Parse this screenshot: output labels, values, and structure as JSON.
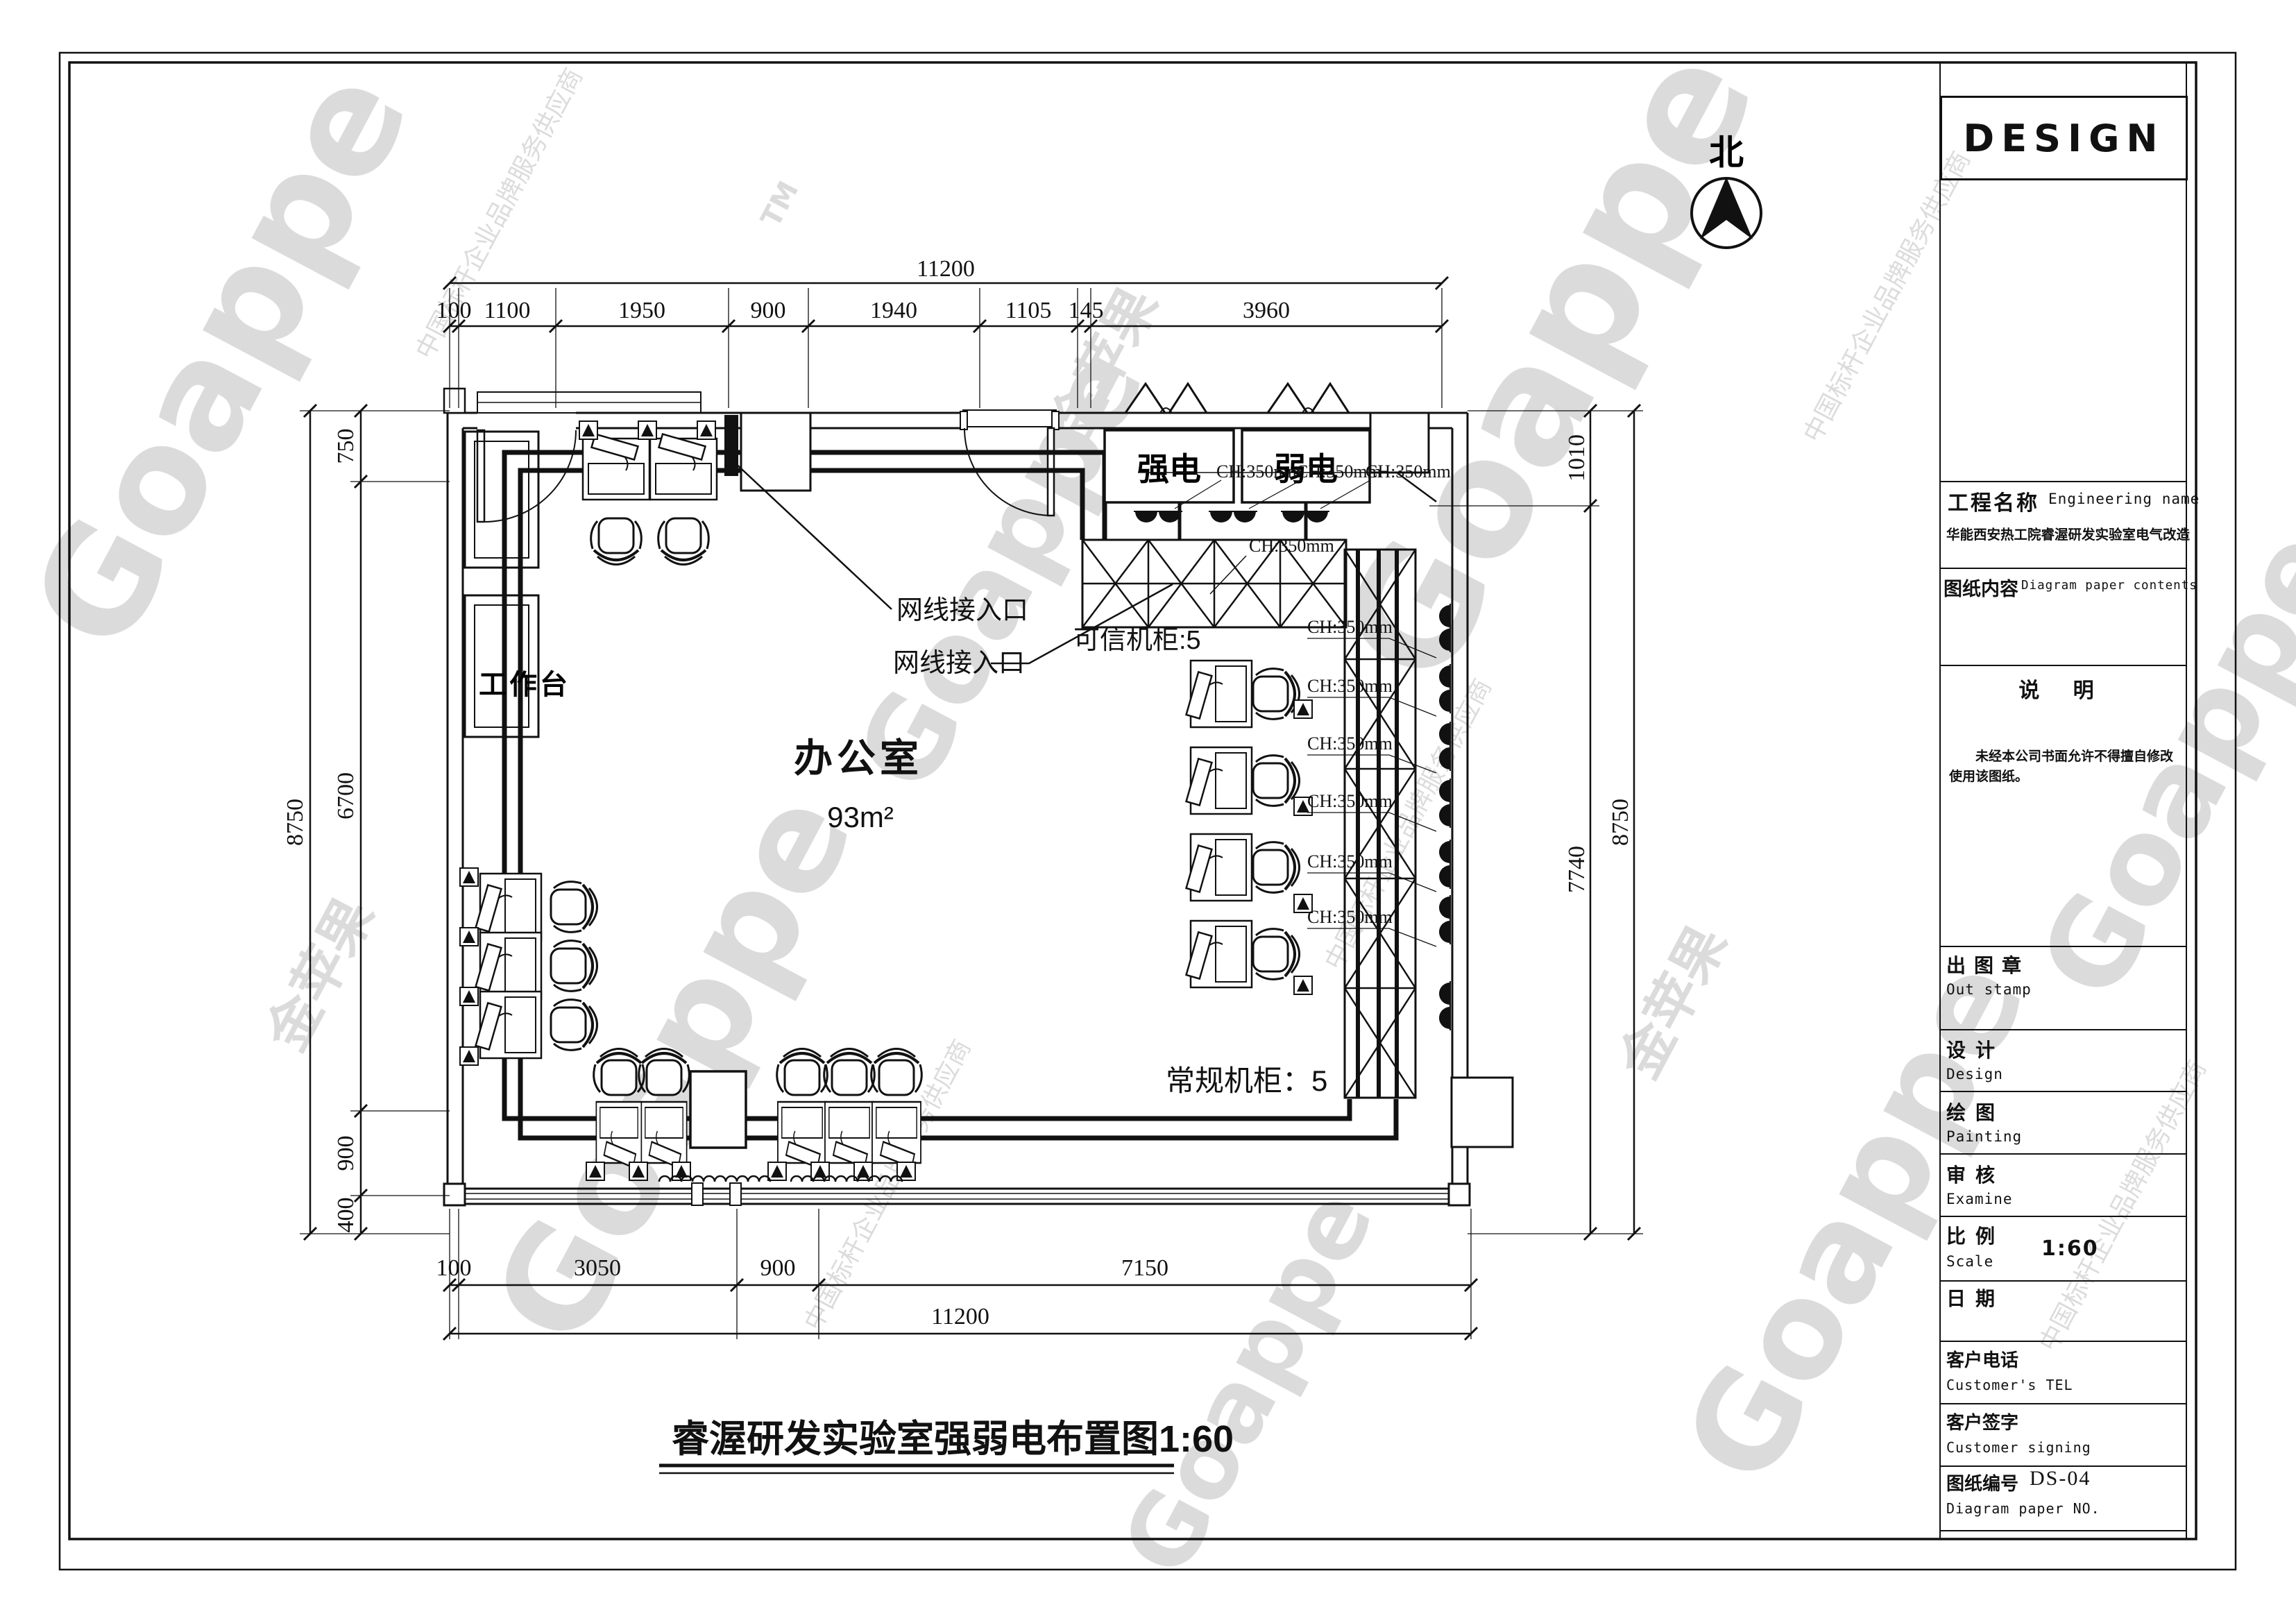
{
  "watermark": {
    "brand": "Goappe",
    "name_cn": "金苹果",
    "tagline": "中国标杆企业品牌服务供应商",
    "tm": "TM"
  },
  "north": {
    "label": "北"
  },
  "plan": {
    "room_name": "办公室",
    "room_area": "93m²",
    "strong_power": "强电",
    "weak_power": "弱电",
    "workbench": "工作台",
    "net_port": "网线接入口",
    "trusted_cabinet": "可信机柜:5",
    "regular_cabinet": "常规机柜：5",
    "cable_height": "CH:350mm",
    "title": "睿渥研发实验室强弱电布置图1:60"
  },
  "dims": {
    "top_total": "11200",
    "top_segments": [
      "100",
      "1100",
      "1950",
      "900",
      "1940",
      "1105",
      "145",
      "3960"
    ],
    "left_total": "8750",
    "left_segments": [
      "750",
      "6700",
      "900",
      "400"
    ],
    "right_segments": [
      "1010",
      "7740"
    ],
    "right_total": "8750",
    "bottom_segments": [
      "100",
      "3050",
      "900",
      "7150"
    ],
    "bottom_total": "11200"
  },
  "titleblock": {
    "brand": "DESIGN",
    "project_label": "工程名称",
    "project_label_en": "Engineering name",
    "project_name": "华能西安热工院睿渥研发实验室电气改造",
    "content_label": "图纸内容",
    "content_label_en": "Diagram paper contents",
    "notes_title": "说 明",
    "notes_text": "未经本公司书面允许不得擅自修改使用该图纸。",
    "stamp_label": "出图章",
    "stamp_label_en": "Out stamp",
    "design_label": "设计",
    "design_label_en": "Design",
    "painting_label": "绘图",
    "painting_label_en": "Painting",
    "examine_label": "审核",
    "examine_label_en": "Examine",
    "scale_label": "比例",
    "scale_label_en": "Scale",
    "scale_value": "1:60",
    "date_label": "日期",
    "tel_label": "客户电话",
    "tel_label_en": "Customer's TEL",
    "sign_label": "客户签字",
    "sign_label_en": "Customer signing",
    "no_label": "图纸编号",
    "no_label_en": "Diagram paper NO.",
    "no_value": "DS-04"
  }
}
